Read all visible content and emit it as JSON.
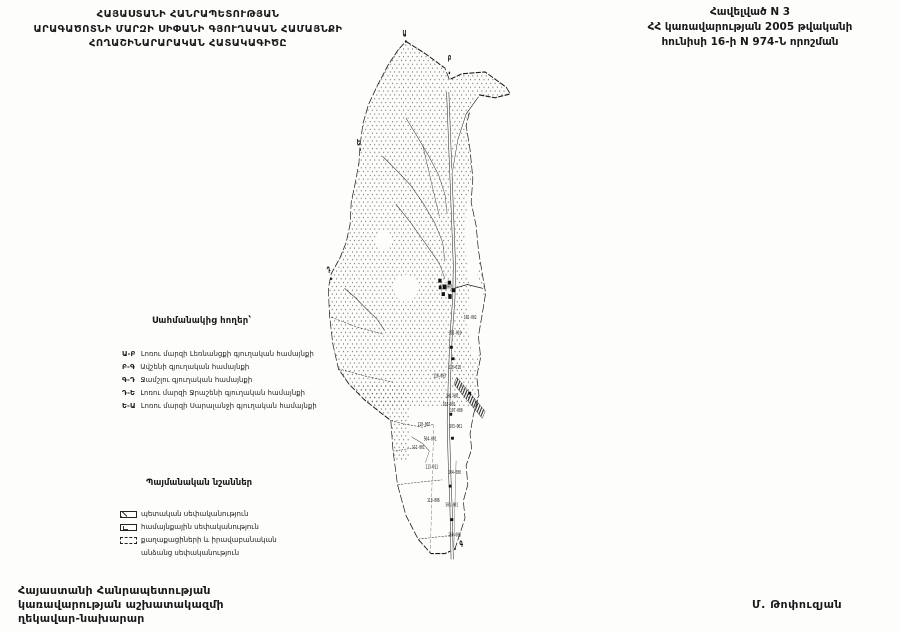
{
  "header": {
    "title_line1": "ՀԱՅԱՍՏԱՆԻ ՀԱՆՐԱՊԵՏՈՒԹՅԱՆ",
    "title_line2": "ԱՐԱԳԱԾՈՏՆԻ ՄԱՐԶԻ ՍԻՓԱՆԻ ԳՅՈՒՂԱԿԱՆ ՀԱՄԱՅՆՔԻ",
    "title_line3": "ՀՈՂԱՇԻՆԱՐԱՐԱԿԱՆ ՀԱՏԱԿԱԳԻԾԸ",
    "annex_line1": "Հավելված N 3",
    "annex_line2": "ՀՀ կառավարության 2005 թվականի",
    "annex_line3": "հունիսի 16-ի N 974-Ն որոշման"
  },
  "adjacent_lands": {
    "heading": "Սահմանակից հողեր՝",
    "items": [
      {
        "code": "Ա-Բ",
        "name": "Լոռու մարզի Լեռնանցքի գյուղական համայնքի"
      },
      {
        "code": "Բ-Գ",
        "name": "Ավշենի գյուղական համայնքի"
      },
      {
        "code": "Գ-Դ",
        "name": "Ջամշլու գյուղական համայնքի"
      },
      {
        "code": "Դ-Ե",
        "name": "Լոռու մարզի Ջրաշենի գյուղական համայնքի"
      },
      {
        "code": "Ե-Ա",
        "name": "Լոռու մարզի Սարալանջի գյուղական համայնքի"
      }
    ]
  },
  "legend": {
    "heading": "Պայմանական նշաններ",
    "items": [
      {
        "symbol": "state-ownership-symbol",
        "label": "պետական սեփականություն"
      },
      {
        "symbol": "community-ownership-symbol",
        "label": "համայնքային սեփականություն"
      },
      {
        "symbol": "private-ownership-symbol",
        "label": "քաղաքացիների և իրավաբանական"
      }
    ],
    "item3_continuation": "անձանց սեփականություն"
  },
  "signature": {
    "line1": "Հայաստանի Հանրապետության",
    "line2": "կառավարության աշխատակազմի",
    "line3": "ղեկավար-նախարար",
    "name": "Մ. Թոփուզյան"
  },
  "map": {
    "boundary_letters": [
      {
        "text": "Ա",
        "x": 464,
        "y": 37
      },
      {
        "text": "Բ",
        "x": 545,
        "y": 63
      },
      {
        "text": "Գ",
        "x": 566,
        "y": 570
      },
      {
        "text": "Դ",
        "x": 328,
        "y": 284
      },
      {
        "text": "Ե",
        "x": 382,
        "y": 151
      }
    ],
    "parcel_labels": [
      {
        "text": "631-001",
        "x": 531,
        "y": 300
      },
      {
        "text": "102-002",
        "x": 574,
        "y": 332
      },
      {
        "text": "103-010",
        "x": 547,
        "y": 348
      },
      {
        "text": "110-013",
        "x": 546,
        "y": 384
      },
      {
        "text": "110-003",
        "x": 519,
        "y": 393
      },
      {
        "text": "101-001",
        "x": 542,
        "y": 414
      },
      {
        "text": "103-001",
        "x": 536,
        "y": 423
      },
      {
        "text": "107-000",
        "x": 549,
        "y": 429
      },
      {
        "text": "110-007",
        "x": 491,
        "y": 444
      },
      {
        "text": "503-001",
        "x": 548,
        "y": 446
      },
      {
        "text": "504-001",
        "x": 502,
        "y": 459
      },
      {
        "text": "111-001",
        "x": 481,
        "y": 468
      },
      {
        "text": "113-011",
        "x": 505,
        "y": 488
      },
      {
        "text": "104-000",
        "x": 546,
        "y": 494
      },
      {
        "text": "113-006",
        "x": 508,
        "y": 523
      },
      {
        "text": "501-001",
        "x": 541,
        "y": 528
      },
      {
        "text": "160-005",
        "x": 546,
        "y": 559
      }
    ]
  },
  "colors": {
    "ink": "#1a1a1a",
    "paper": "#fdfdfc"
  }
}
